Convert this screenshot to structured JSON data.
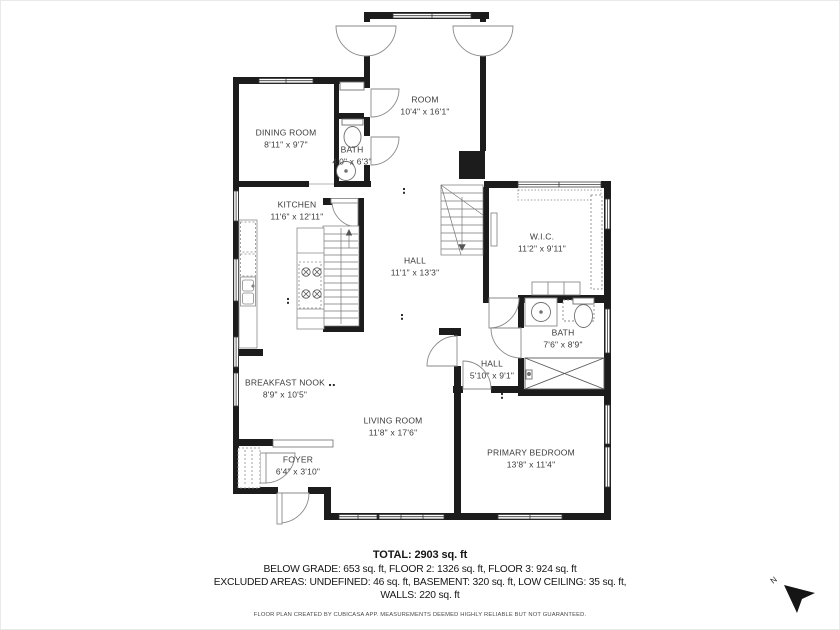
{
  "plan": {
    "rooms": [
      {
        "id": "dining-room",
        "name": "DINING ROOM",
        "dims": "8'11\" x 9'7\""
      },
      {
        "id": "room",
        "name": "ROOM",
        "dims": "10'4\" x 16'1\""
      },
      {
        "id": "bath-upper",
        "name": "BATH",
        "dims": "4'0\" x 6'3\""
      },
      {
        "id": "kitchen",
        "name": "KITCHEN",
        "dims": "11'6\" x 12'11\""
      },
      {
        "id": "hall-main",
        "name": "HALL",
        "dims": "11'1\" x 13'3\""
      },
      {
        "id": "walk-in-closet",
        "name": "W.I.C.",
        "dims": "11'2\" x 9'11\""
      },
      {
        "id": "bath-primary",
        "name": "BATH",
        "dims": "7'6\" x 8'9\""
      },
      {
        "id": "hall-small",
        "name": "HALL",
        "dims": "5'10\" x 9'1\""
      },
      {
        "id": "breakfast-nook",
        "name": "BREAKFAST NOOK",
        "dims": "8'9\" x 10'5\""
      },
      {
        "id": "living-room",
        "name": "LIVING ROOM",
        "dims": "11'8\" x 17'6\""
      },
      {
        "id": "foyer",
        "name": "FOYER",
        "dims": "6'4\" x 3'10\""
      },
      {
        "id": "primary-bedroom",
        "name": "PRIMARY BEDROOM",
        "dims": "13'8\" x 11'4\""
      }
    ],
    "north_label": "N"
  },
  "summary": {
    "total": "TOTAL: 2903 sq. ft",
    "floors": "BELOW GRADE: 653 sq. ft, FLOOR 2: 1326 sq. ft, FLOOR 3: 924 sq. ft",
    "excluded": "EXCLUDED AREAS: UNDEFINED: 46 sq. ft, BASEMENT: 320 sq. ft, LOW CEILING: 35 sq. ft,",
    "walls": "WALLS: 220 sq. ft"
  },
  "disclaimer": "FLOOR PLAN CREATED BY CUBICASA APP. MEASUREMENTS DEEMED HIGHLY RELIABLE BUT NOT GUARANTEED.",
  "colors": {
    "wall": "#1c1c1c",
    "background": "#ffffff",
    "label": "#3a3a3a"
  }
}
